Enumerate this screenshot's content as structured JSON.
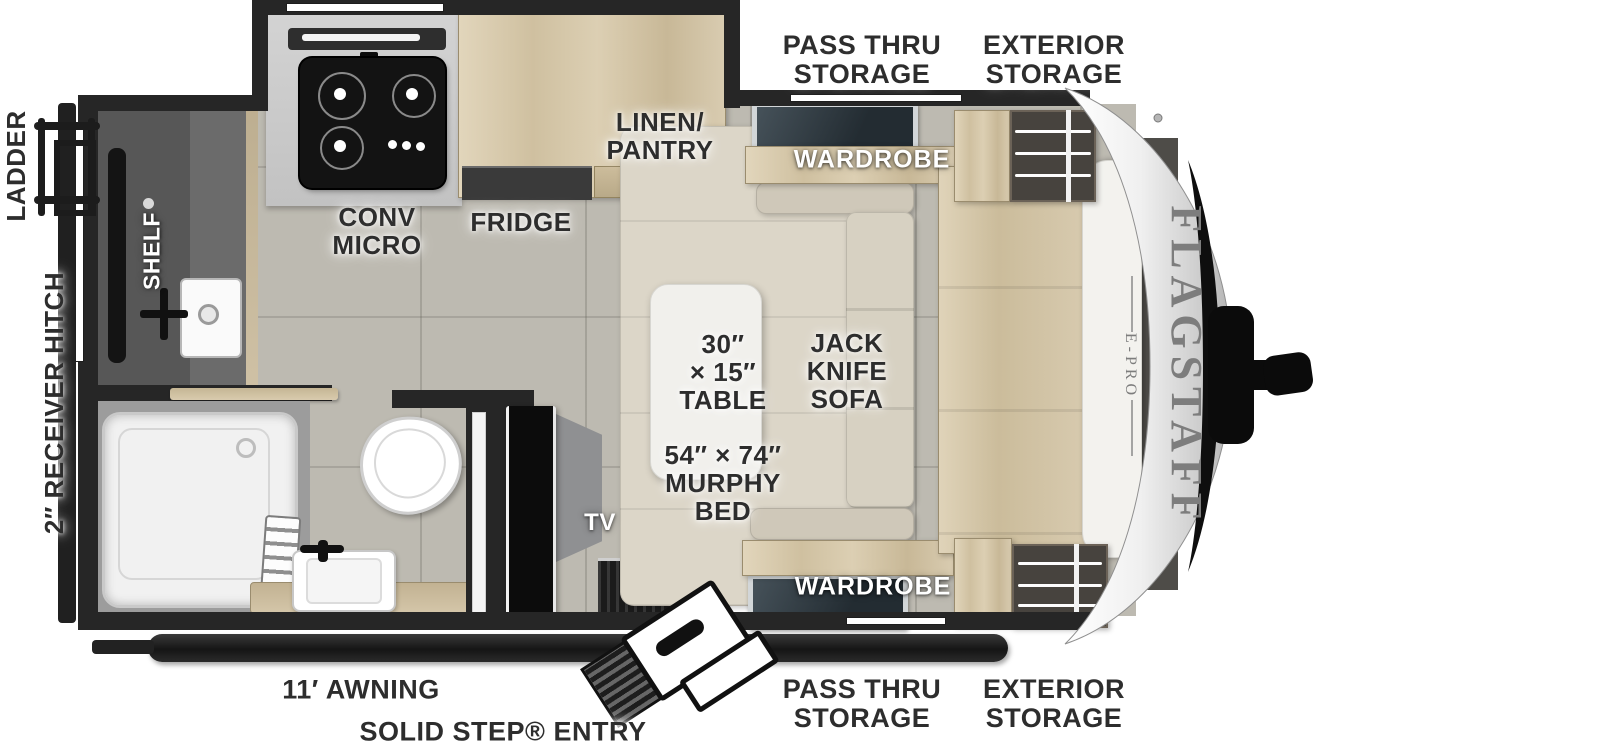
{
  "meta": {
    "title": "Flagstaff E-Pro travel trailer floor plan"
  },
  "brand": {
    "name": "FLAGSTAFF",
    "sub_line": "E-PRO"
  },
  "exterior_labels": {
    "pass_thru_top": "PASS THRU\nSTORAGE",
    "exterior_storage_top": "EXTERIOR\nSTORAGE",
    "ladder": "LADDER",
    "receiver_hitch": "2″ RECEIVER HITCH",
    "awning": "11′ AWNING",
    "entry": "SOLID STEP® ENTRY",
    "pass_thru_bottom": "PASS THRU\nSTORAGE",
    "exterior_storage_bottom": "EXTERIOR\nSTORAGE"
  },
  "interior_labels": {
    "shelf": "SHELF",
    "linen_pantry": "LINEN/\nPANTRY",
    "conv_micro": "CONV\nMICRO",
    "fridge": "FRIDGE",
    "wardrobe_top": "WARDROBE",
    "wardrobe_bottom": "WARDROBE",
    "table": "30″\n× 15″\nTABLE",
    "sofa": "JACK\nKNIFE\nSOFA",
    "murphy_bed": "54″ × 74″\nMURPHY\nBED",
    "tv": "TV"
  },
  "colors": {
    "wall": "#262626",
    "floor": "#bdbab1",
    "wood": "#d5c7aa",
    "cushion": "#d8d2c4",
    "counter": "#c9c9c9",
    "label": "#2d2d2d",
    "label_white": "#ffffff",
    "brand_gray": "#7d7d7d"
  }
}
